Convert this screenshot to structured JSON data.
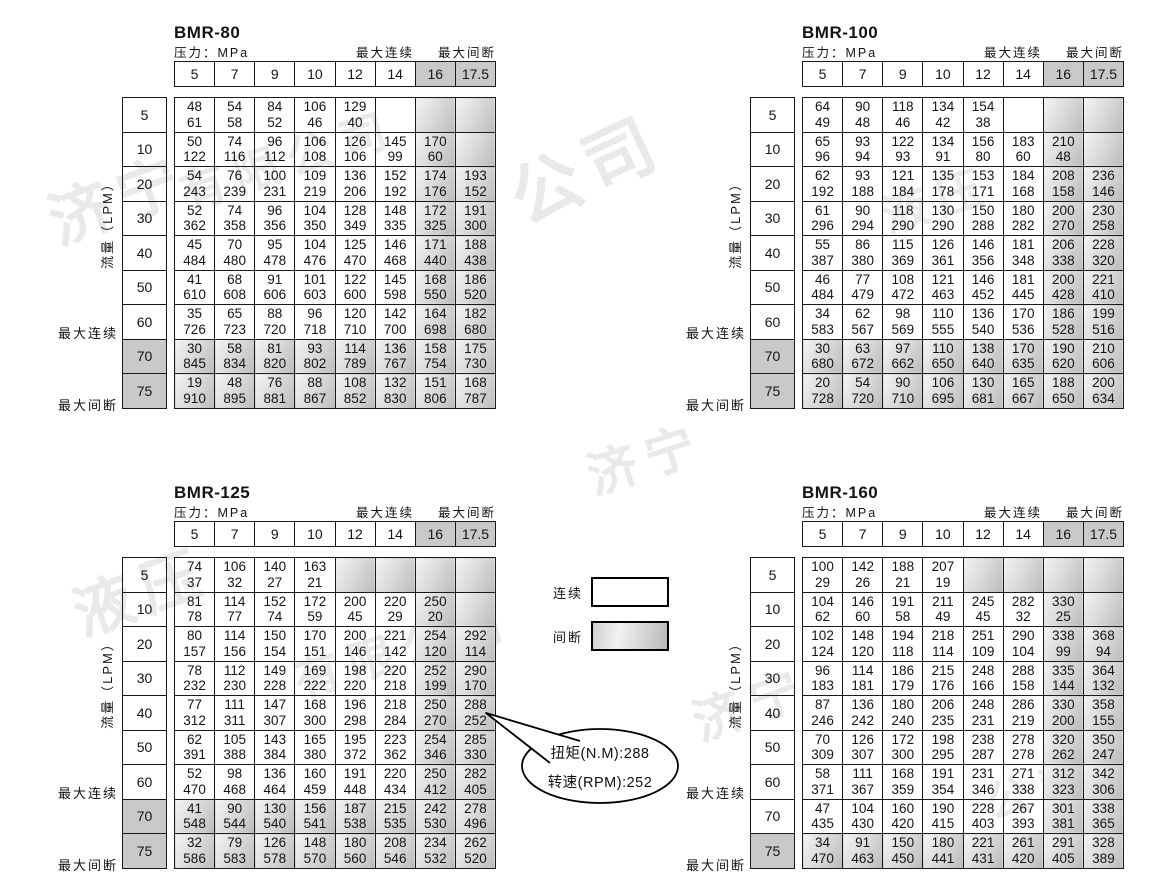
{
  "labels": {
    "pressure": "压力：MPa",
    "max_continuous": "最大连续",
    "max_intermittent": "最大间断",
    "flow": "流量（LPM）"
  },
  "legend": {
    "continuous": "连续",
    "intermittent": "间断"
  },
  "callout": {
    "torque": "扭矩(N.M):288",
    "speed": "转速(RPM):252"
  },
  "pressure_columns": [
    "5",
    "7",
    "9",
    "10",
    "12",
    "14",
    "16",
    "17.5"
  ],
  "shaded_pressure_columns": [
    "16",
    "17.5"
  ],
  "flow_rows": [
    "5",
    "10",
    "20",
    "30",
    "40",
    "50",
    "60",
    "70",
    "75"
  ],
  "cell_value_meaning": [
    "扭矩 N.M",
    "转速 RPM"
  ],
  "tables": [
    {
      "title": "BMR-80",
      "shaded_rows": [
        "70",
        "75"
      ],
      "cells": [
        [
          [
            48,
            61
          ],
          [
            54,
            58
          ],
          [
            84,
            52
          ],
          [
            106,
            46
          ],
          [
            129,
            40
          ],
          null,
          "s",
          "s"
        ],
        [
          [
            50,
            122
          ],
          [
            74,
            116
          ],
          [
            96,
            112
          ],
          [
            106,
            108
          ],
          [
            126,
            106
          ],
          [
            145,
            99
          ],
          [
            170,
            60
          ],
          "s"
        ],
        [
          [
            54,
            243
          ],
          [
            76,
            239
          ],
          [
            100,
            231
          ],
          [
            109,
            219
          ],
          [
            136,
            206
          ],
          [
            152,
            192
          ],
          [
            174,
            176
          ],
          [
            193,
            152
          ]
        ],
        [
          [
            52,
            362
          ],
          [
            74,
            358
          ],
          [
            96,
            356
          ],
          [
            104,
            350
          ],
          [
            128,
            349
          ],
          [
            148,
            335
          ],
          [
            172,
            325
          ],
          [
            191,
            300
          ]
        ],
        [
          [
            45,
            484
          ],
          [
            70,
            480
          ],
          [
            95,
            478
          ],
          [
            104,
            476
          ],
          [
            125,
            470
          ],
          [
            146,
            468
          ],
          [
            171,
            440
          ],
          [
            188,
            438
          ]
        ],
        [
          [
            41,
            610
          ],
          [
            68,
            608
          ],
          [
            91,
            606
          ],
          [
            101,
            603
          ],
          [
            122,
            600
          ],
          [
            145,
            598
          ],
          [
            168,
            550
          ],
          [
            186,
            520
          ]
        ],
        [
          [
            35,
            726
          ],
          [
            65,
            723
          ],
          [
            88,
            720
          ],
          [
            96,
            718
          ],
          [
            120,
            710
          ],
          [
            142,
            700
          ],
          [
            164,
            698
          ],
          [
            182,
            680
          ]
        ],
        [
          [
            30,
            845
          ],
          [
            58,
            834
          ],
          [
            81,
            820
          ],
          [
            93,
            802
          ],
          [
            114,
            789
          ],
          [
            136,
            767
          ],
          [
            158,
            754
          ],
          [
            175,
            730
          ]
        ],
        [
          [
            19,
            910
          ],
          [
            48,
            895
          ],
          [
            76,
            881
          ],
          [
            88,
            867
          ],
          [
            108,
            852
          ],
          [
            132,
            830
          ],
          [
            151,
            806
          ],
          [
            168,
            787
          ]
        ]
      ]
    },
    {
      "title": "BMR-100",
      "shaded_rows": [
        "70",
        "75"
      ],
      "cells": [
        [
          [
            64,
            49
          ],
          [
            90,
            48
          ],
          [
            118,
            46
          ],
          [
            134,
            42
          ],
          [
            154,
            38
          ],
          null,
          "s",
          "s"
        ],
        [
          [
            65,
            96
          ],
          [
            93,
            94
          ],
          [
            122,
            93
          ],
          [
            134,
            91
          ],
          [
            156,
            80
          ],
          [
            183,
            60
          ],
          [
            210,
            48
          ],
          "s"
        ],
        [
          [
            62,
            192
          ],
          [
            93,
            188
          ],
          [
            121,
            184
          ],
          [
            135,
            178
          ],
          [
            153,
            171
          ],
          [
            184,
            168
          ],
          [
            208,
            158
          ],
          [
            236,
            146
          ]
        ],
        [
          [
            61,
            296
          ],
          [
            90,
            294
          ],
          [
            118,
            290
          ],
          [
            130,
            290
          ],
          [
            150,
            288
          ],
          [
            180,
            282
          ],
          [
            200,
            270
          ],
          [
            230,
            258
          ]
        ],
        [
          [
            55,
            387
          ],
          [
            86,
            380
          ],
          [
            115,
            369
          ],
          [
            126,
            361
          ],
          [
            146,
            356
          ],
          [
            181,
            348
          ],
          [
            206,
            338
          ],
          [
            228,
            320
          ]
        ],
        [
          [
            46,
            484
          ],
          [
            77,
            479
          ],
          [
            108,
            472
          ],
          [
            121,
            463
          ],
          [
            146,
            452
          ],
          [
            181,
            445
          ],
          [
            200,
            428
          ],
          [
            221,
            410
          ]
        ],
        [
          [
            34,
            583
          ],
          [
            62,
            567
          ],
          [
            98,
            569
          ],
          [
            110,
            555
          ],
          [
            136,
            540
          ],
          [
            170,
            536
          ],
          [
            186,
            528
          ],
          [
            199,
            516
          ]
        ],
        [
          [
            30,
            680
          ],
          [
            63,
            672
          ],
          [
            97,
            662
          ],
          [
            110,
            650
          ],
          [
            138,
            640
          ],
          [
            170,
            635
          ],
          [
            190,
            620
          ],
          [
            210,
            606
          ]
        ],
        [
          [
            20,
            728
          ],
          [
            54,
            720
          ],
          [
            90,
            710
          ],
          [
            106,
            695
          ],
          [
            130,
            681
          ],
          [
            165,
            667
          ],
          [
            188,
            650
          ],
          [
            200,
            634
          ]
        ]
      ]
    },
    {
      "title": "BMR-125",
      "shaded_rows": [
        "70",
        "75"
      ],
      "cells": [
        [
          [
            74,
            37
          ],
          [
            106,
            32
          ],
          [
            140,
            27
          ],
          [
            163,
            21
          ],
          "s",
          "s",
          "s",
          "s"
        ],
        [
          [
            81,
            78
          ],
          [
            114,
            77
          ],
          [
            152,
            74
          ],
          [
            172,
            59
          ],
          [
            200,
            45
          ],
          [
            220,
            29
          ],
          [
            250,
            20
          ],
          "s"
        ],
        [
          [
            80,
            157
          ],
          [
            114,
            156
          ],
          [
            150,
            154
          ],
          [
            170,
            151
          ],
          [
            200,
            146
          ],
          [
            221,
            142
          ],
          [
            254,
            120
          ],
          [
            292,
            114
          ]
        ],
        [
          [
            78,
            232
          ],
          [
            112,
            230
          ],
          [
            149,
            228
          ],
          [
            169,
            222
          ],
          [
            198,
            220
          ],
          [
            220,
            218
          ],
          [
            252,
            199
          ],
          [
            290,
            170
          ]
        ],
        [
          [
            77,
            312
          ],
          [
            111,
            311
          ],
          [
            147,
            307
          ],
          [
            168,
            300
          ],
          [
            196,
            298
          ],
          [
            218,
            284
          ],
          [
            250,
            270
          ],
          [
            288,
            252
          ]
        ],
        [
          [
            62,
            391
          ],
          [
            105,
            388
          ],
          [
            143,
            384
          ],
          [
            165,
            380
          ],
          [
            195,
            372
          ],
          [
            223,
            362
          ],
          [
            254,
            346
          ],
          [
            285,
            330
          ]
        ],
        [
          [
            52,
            470
          ],
          [
            98,
            468
          ],
          [
            136,
            464
          ],
          [
            160,
            459
          ],
          [
            191,
            448
          ],
          [
            220,
            434
          ],
          [
            250,
            412
          ],
          [
            282,
            405
          ]
        ],
        [
          [
            41,
            548
          ],
          [
            90,
            544
          ],
          [
            130,
            540
          ],
          [
            156,
            541
          ],
          [
            187,
            538
          ],
          [
            215,
            535
          ],
          [
            242,
            530
          ],
          [
            278,
            496
          ]
        ],
        [
          [
            32,
            586
          ],
          [
            79,
            583
          ],
          [
            126,
            578
          ],
          [
            148,
            570
          ],
          [
            180,
            560
          ],
          [
            208,
            546
          ],
          [
            234,
            532
          ],
          [
            262,
            520
          ]
        ]
      ]
    },
    {
      "title": "BMR-160",
      "shaded_rows": [
        "75"
      ],
      "cells": [
        [
          [
            100,
            29
          ],
          [
            142,
            26
          ],
          [
            188,
            21
          ],
          [
            207,
            19
          ],
          "s",
          "s",
          "s",
          "s"
        ],
        [
          [
            104,
            62
          ],
          [
            146,
            60
          ],
          [
            191,
            58
          ],
          [
            211,
            49
          ],
          [
            245,
            45
          ],
          [
            282,
            32
          ],
          [
            330,
            25
          ],
          "s"
        ],
        [
          [
            102,
            124
          ],
          [
            148,
            120
          ],
          [
            194,
            118
          ],
          [
            218,
            114
          ],
          [
            251,
            109
          ],
          [
            290,
            104
          ],
          [
            338,
            99
          ],
          [
            368,
            94
          ]
        ],
        [
          [
            96,
            183
          ],
          [
            114,
            181
          ],
          [
            186,
            179
          ],
          [
            215,
            176
          ],
          [
            248,
            166
          ],
          [
            288,
            158
          ],
          [
            335,
            144
          ],
          [
            364,
            132
          ]
        ],
        [
          [
            87,
            246
          ],
          [
            136,
            242
          ],
          [
            180,
            240
          ],
          [
            206,
            235
          ],
          [
            248,
            231
          ],
          [
            286,
            219
          ],
          [
            330,
            200
          ],
          [
            358,
            155
          ]
        ],
        [
          [
            70,
            309
          ],
          [
            126,
            307
          ],
          [
            172,
            300
          ],
          [
            198,
            295
          ],
          [
            238,
            287
          ],
          [
            278,
            278
          ],
          [
            320,
            262
          ],
          [
            350,
            247
          ]
        ],
        [
          [
            58,
            371
          ],
          [
            111,
            367
          ],
          [
            168,
            359
          ],
          [
            191,
            354
          ],
          [
            231,
            346
          ],
          [
            271,
            338
          ],
          [
            312,
            323
          ],
          [
            342,
            306
          ]
        ],
        [
          [
            47,
            435
          ],
          [
            104,
            430
          ],
          [
            160,
            420
          ],
          [
            190,
            415
          ],
          [
            228,
            403
          ],
          [
            267,
            393
          ],
          [
            301,
            381
          ],
          [
            338,
            365
          ]
        ],
        [
          [
            34,
            470
          ],
          [
            91,
            463
          ],
          [
            150,
            450
          ],
          [
            180,
            441
          ],
          [
            221,
            431
          ],
          [
            261,
            420
          ],
          [
            291,
            405
          ],
          [
            328,
            389
          ]
        ]
      ]
    }
  ],
  "watermarks": [
    "济宁",
    "有限公司",
    "公司",
    "济宁",
    "液压",
    "有限公司",
    "济宁",
    "液压",
    "公司"
  ],
  "colors": {
    "shade_header": "#c9c9c9",
    "shade_cell_light": "#f4f4f4",
    "shade_cell_dark": "#bcbcbc",
    "border": "#1a1a1a",
    "watermark": "#e9e9e9"
  }
}
